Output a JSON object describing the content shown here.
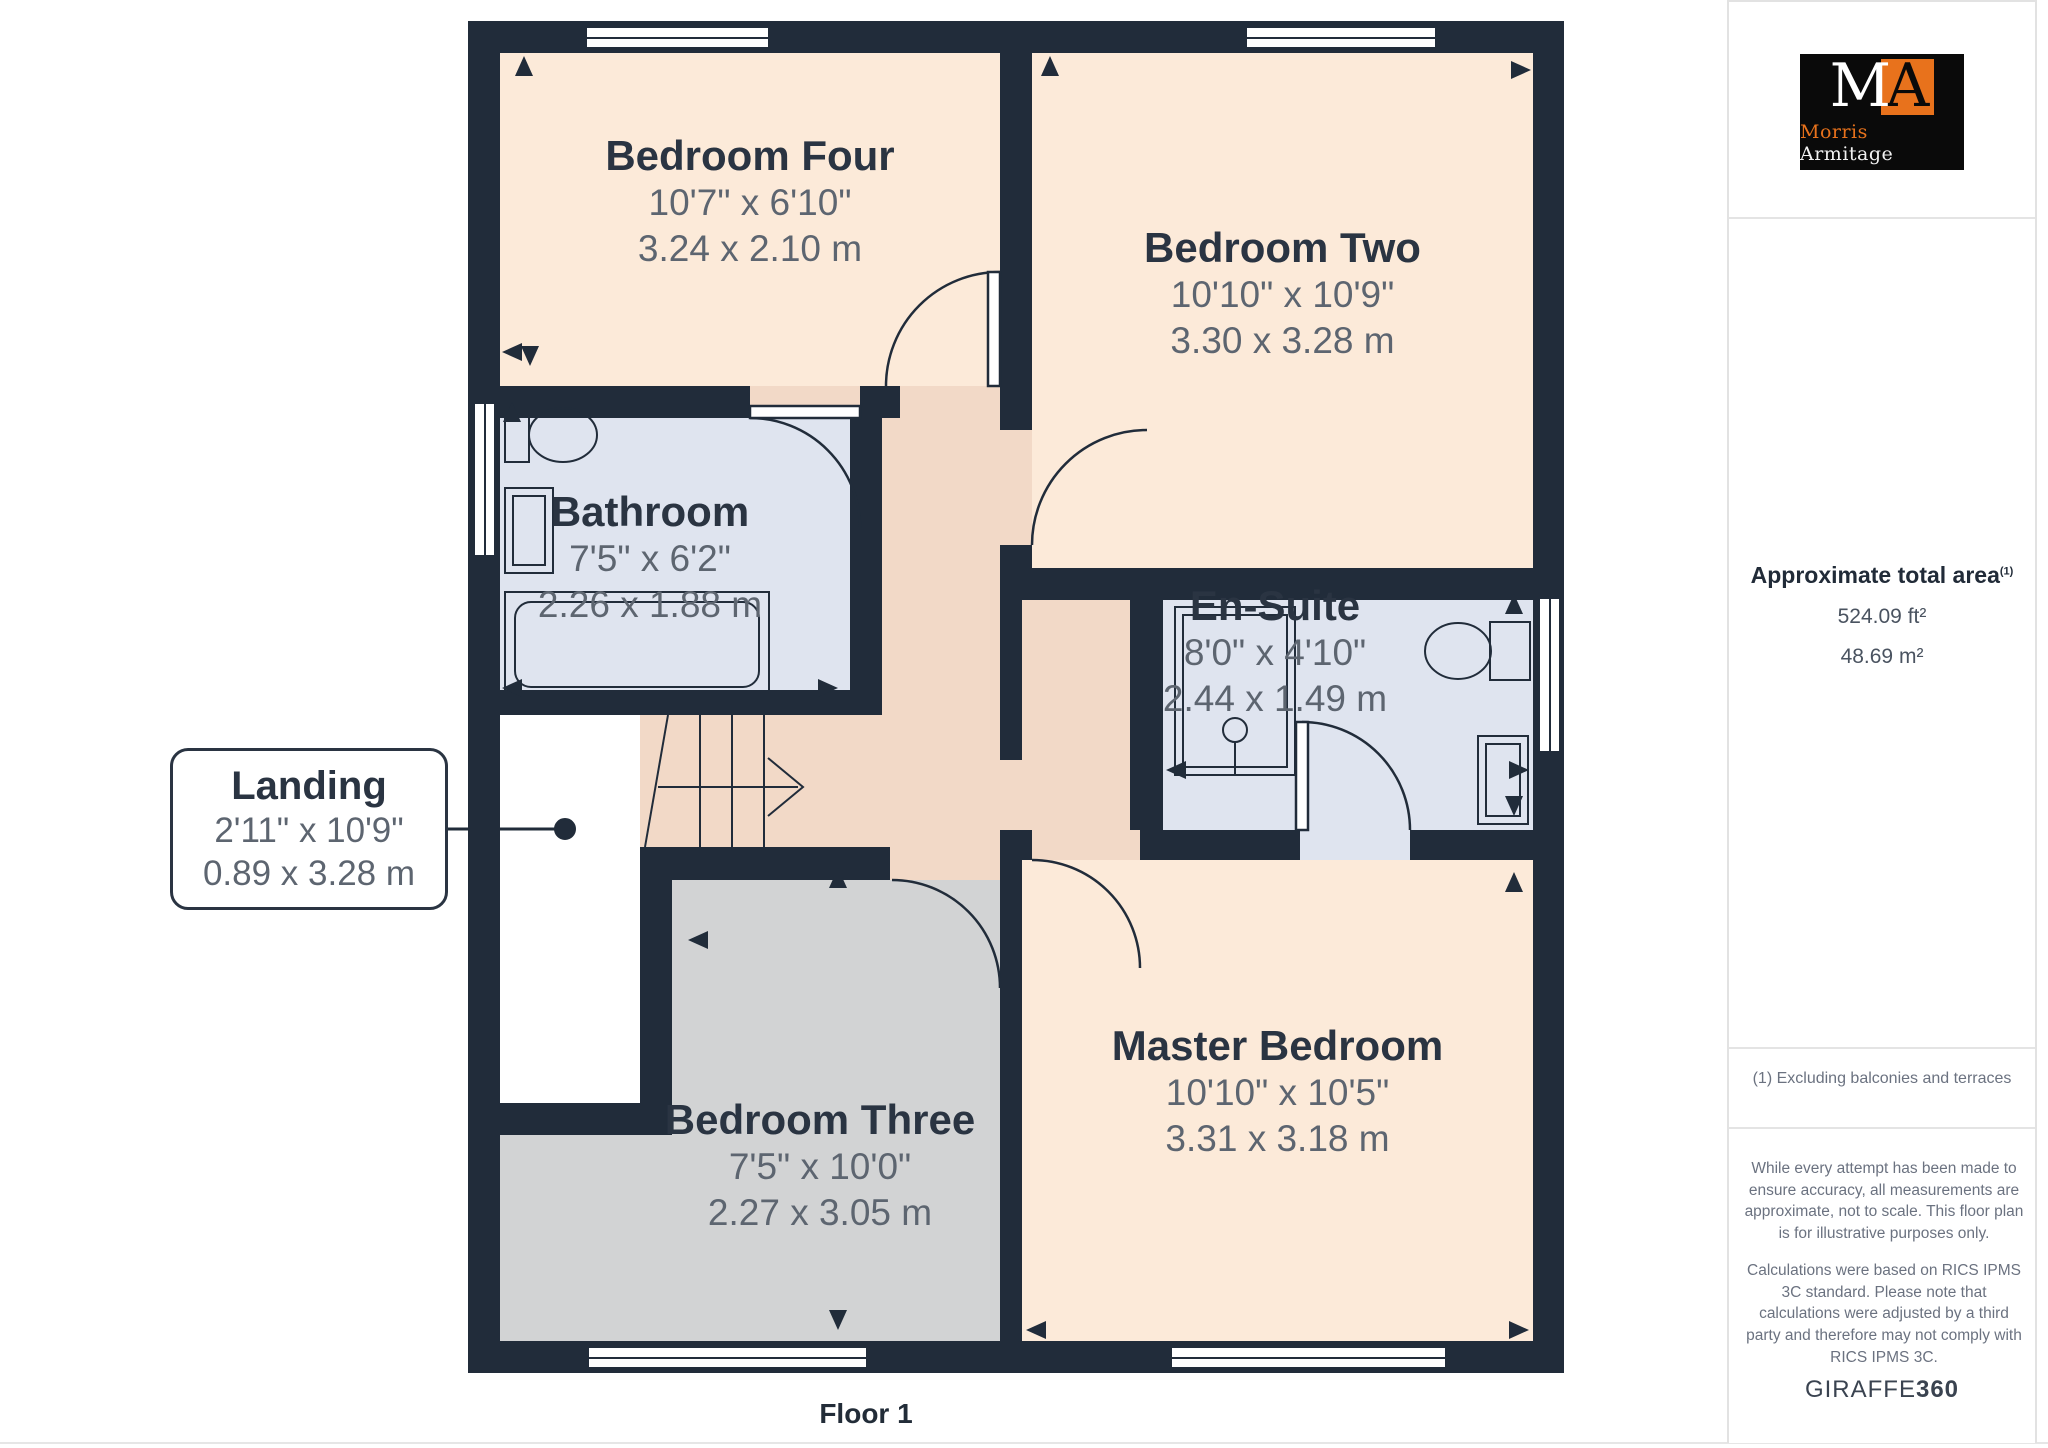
{
  "floor_plan": {
    "floor_label": "Floor 1",
    "rooms": [
      {
        "id": "bedroom-four",
        "name": "Bedroom Four",
        "imperial": "10'7\" x 6'10\"",
        "metric": "3.24 x 2.10 m"
      },
      {
        "id": "bedroom-two",
        "name": "Bedroom Two",
        "imperial": "10'10\" x 10'9\"",
        "metric": "3.30 x 3.28 m"
      },
      {
        "id": "bathroom",
        "name": "Bathroom",
        "imperial": "7'5\" x 6'2\"",
        "metric": "2.26 x 1.88 m"
      },
      {
        "id": "en-suite",
        "name": "En-Suite",
        "imperial": "8'0\" x 4'10\"",
        "metric": "2.44 x 1.49 m"
      },
      {
        "id": "landing",
        "name": "Landing",
        "imperial": "2'11\" x 10'9\"",
        "metric": "0.89 x 3.28 m"
      },
      {
        "id": "bedroom-three",
        "name": "Bedroom Three",
        "imperial": "7'5\" x 10'0\"",
        "metric": "2.27 x 3.05 m"
      },
      {
        "id": "master-bedroom",
        "name": "Master Bedroom",
        "imperial": "10'10\" x 10'5\"",
        "metric": "3.31 x 3.18 m"
      }
    ]
  },
  "sidebar": {
    "logo": {
      "monogram_m": "M",
      "monogram_a": "A",
      "name_first": "Morris",
      "name_second": "Armitage"
    },
    "area": {
      "title": "Approximate total area",
      "footnote_marker": "(1)",
      "sqft": "524.09 ft²",
      "sqm": "48.69 m²"
    },
    "footnote": "(1) Excluding balconies and terraces",
    "disclaimer1": "While every attempt has been made to ensure accuracy, all measurements are approximate, not to scale. This floor plan is for illustrative purposes only.",
    "disclaimer2": "Calculations were based on RICS IPMS 3C standard. Please note that calculations were adjusted by a third party and therefore may not comply with RICS IPMS 3C.",
    "brand": {
      "giraffe": "GIRAFFE",
      "threesixty": "360"
    }
  },
  "colors": {
    "wall": "#212c3a",
    "bedroom_fill": "#fcead9",
    "corridor_fill": "#f2d9c7",
    "wet_room_fill": "#dfe4ef",
    "bedroom_three_fill": "#d2d3d4",
    "label_dark": "#2a3442",
    "dims_gray": "#5d6570",
    "logo_orange": "#e8721c",
    "logo_black": "#0a0a0a"
  }
}
